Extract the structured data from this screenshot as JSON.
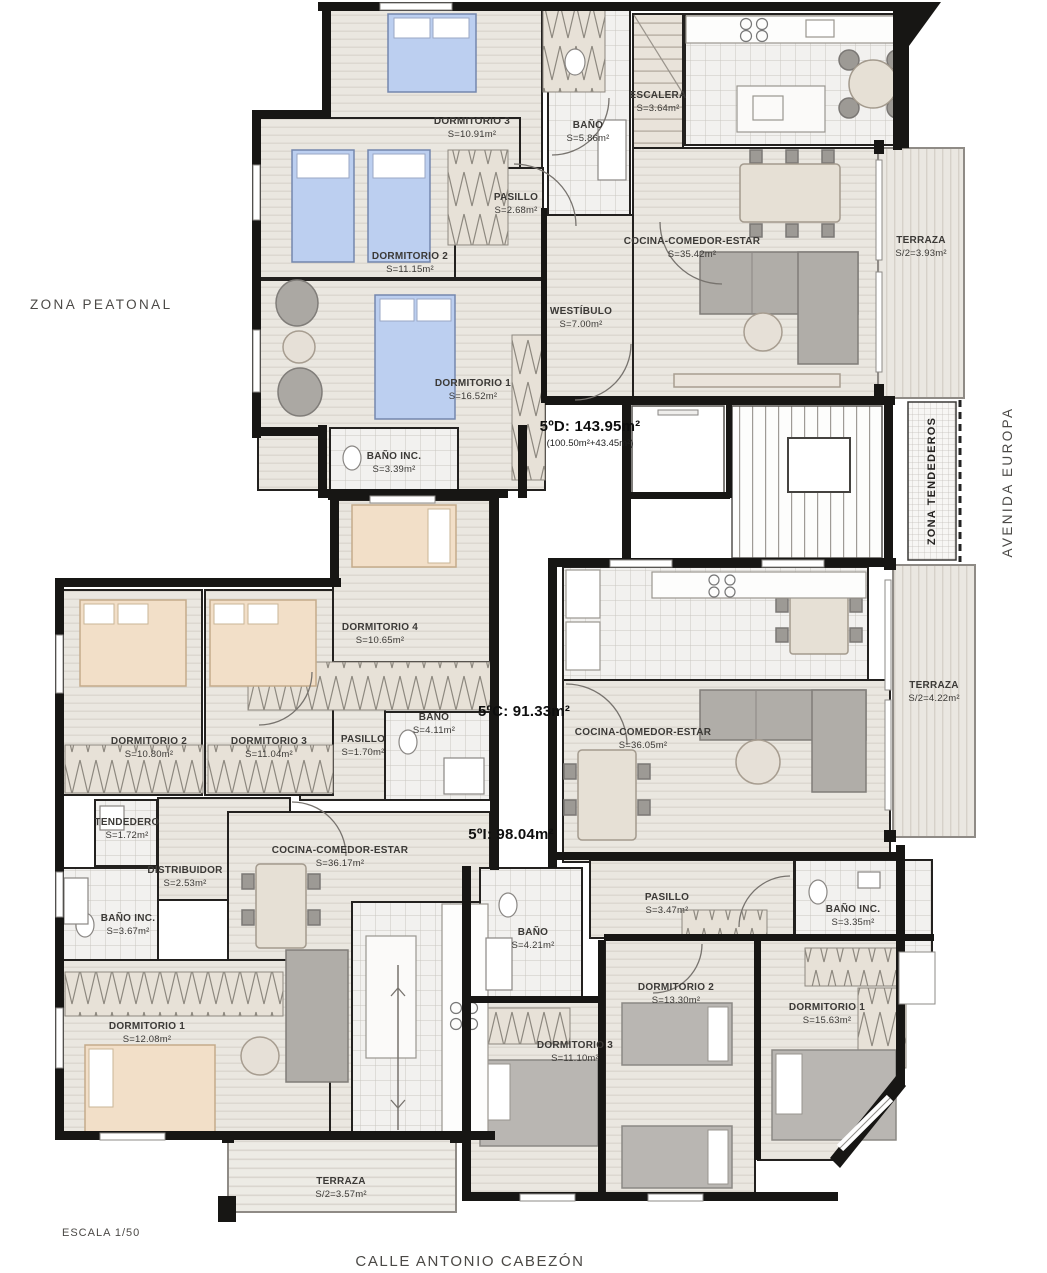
{
  "plan": {
    "streets": {
      "left": "ZONA PEATONAL",
      "right": "AVENIDA EUROPA",
      "bottom": "CALLE ANTONIO CABEZÓN"
    },
    "scale_label": "ESCALA 1/50",
    "common": {
      "stairs": {
        "name": "ESCALERA",
        "area": "S=3.64m²"
      },
      "drying_zone_label": "ZONA TENDEDEROS"
    },
    "apartments": [
      {
        "id": "5ºD",
        "label": "5ºD: 143.95m²",
        "sublabel": "(100.50m²+43.45m²)",
        "rooms": [
          {
            "name": "DORMITORIO 3",
            "area": "S=10.91m²"
          },
          {
            "name": "BAÑO",
            "area": "S=5.86m²"
          },
          {
            "name": "PASILLO",
            "area": "S=2.68m²"
          },
          {
            "name": "DORMITORIO 2",
            "area": "S=11.15m²"
          },
          {
            "name": "COCINA-COMEDOR-ESTAR",
            "area": "S=35.42m²"
          },
          {
            "name": "TERRAZA",
            "area": "S/2=3.93m²"
          },
          {
            "name": "WESTÍBULO",
            "area": "S=7.00m²"
          },
          {
            "name": "DORMITORIO 1",
            "area": "S=16.52m²"
          },
          {
            "name": "BAÑO INC.",
            "area": "S=3.39m²"
          }
        ]
      },
      {
        "id": "5ºC",
        "label": "5ºC: 91.33m²",
        "rooms": [
          {
            "name": "COCINA-COMEDOR-ESTAR",
            "area": "S=36.05m²"
          },
          {
            "name": "TERRAZA",
            "area": "S/2=4.22m²"
          },
          {
            "name": "PASILLO",
            "area": "S=3.47m²"
          },
          {
            "name": "BAÑO",
            "area": "S=4.21m²"
          },
          {
            "name": "BAÑO INC.",
            "area": "S=3.35m²"
          },
          {
            "name": "DORMITORIO 2",
            "area": "S=13.30m²"
          },
          {
            "name": "DORMITORIO 1",
            "area": "S=15.63m²"
          },
          {
            "name": "DORMITORIO 3",
            "area": "S=11.10m²"
          }
        ]
      },
      {
        "id": "5ºI",
        "label": "5ºI: 98.04m²",
        "rooms": [
          {
            "name": "DORMITORIO 4",
            "area": "S=10.65m²"
          },
          {
            "name": "BAÑO",
            "area": "S=4.11m²"
          },
          {
            "name": "PASILLO",
            "area": "S=1.70m²"
          },
          {
            "name": "DORMITORIO 2",
            "area": "S=10.80m²"
          },
          {
            "name": "DORMITORIO 3",
            "area": "S=11.04m²"
          },
          {
            "name": "TENDEDERO",
            "area": "S=1.72m²"
          },
          {
            "name": "DISTRIBUIDOR",
            "area": "S=2.53m²"
          },
          {
            "name": "COCINA-COMEDOR-ESTAR",
            "area": "S=36.17m²"
          },
          {
            "name": "BAÑO INC.",
            "area": "S=3.67m²"
          },
          {
            "name": "DORMITORIO 1",
            "area": "S=12.08m²"
          },
          {
            "name": "TERRAZA",
            "area": "S/2=3.57m²"
          }
        ]
      }
    ]
  }
}
